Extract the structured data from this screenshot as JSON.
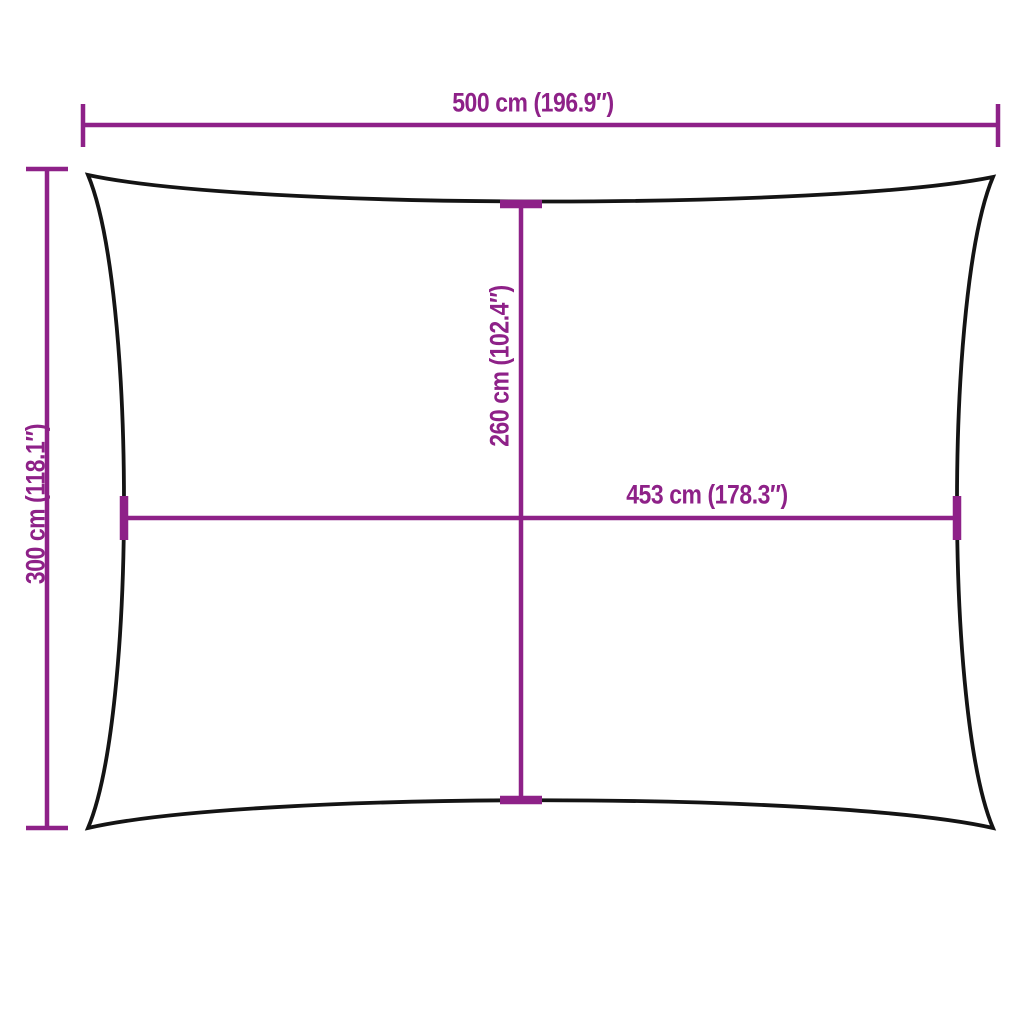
{
  "diagram": {
    "colors": {
      "dimension": "#8E2188",
      "outline": "#141414",
      "background": "#FFFFFF"
    },
    "dimensions": {
      "top_width": {
        "label": "500 cm (196.9″)"
      },
      "left_height": {
        "label": "300 cm (118.1″)"
      },
      "center_height": {
        "label": "260 cm (102.4″)"
      },
      "center_width": {
        "label": "453 cm (178.3″)"
      }
    }
  }
}
